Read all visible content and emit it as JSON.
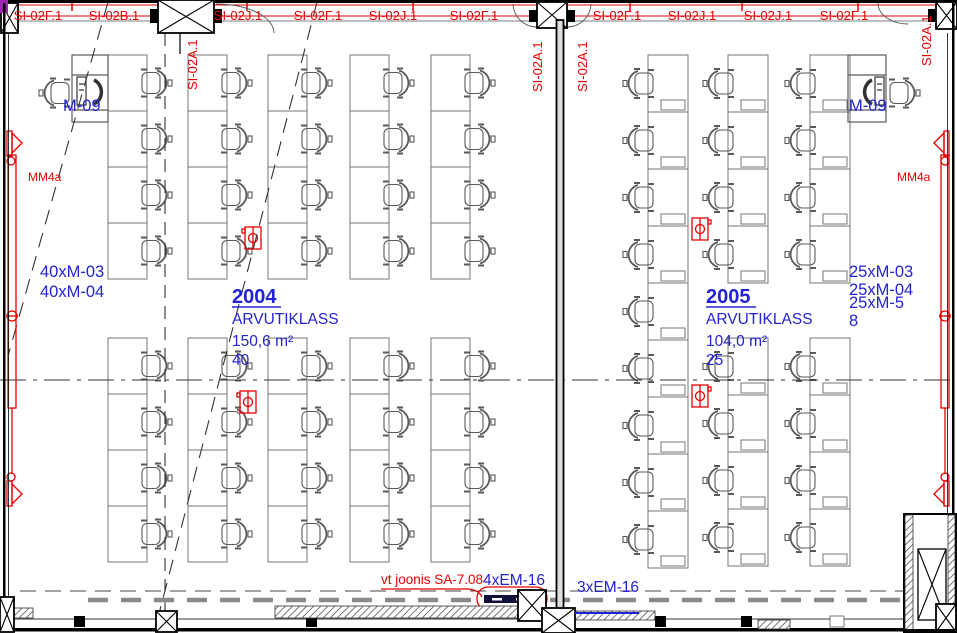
{
  "colors": {
    "annotation_red": "#e60000",
    "label_blue": "#2323d6",
    "wall_black": "#000000",
    "furniture_gray": "#767676",
    "corner_magenta": "#9c27b0"
  },
  "ann": {
    "top_labels": [
      "SI-02F.1",
      "SI-02B.1",
      "SI-02J.1",
      "SI-02F.1",
      "SI-02J.1",
      "SI-02F.1",
      "SI-02F.1",
      "SI-02J.1",
      "SI-02J.1",
      "SI-02F.1"
    ],
    "vertical_labels": [
      "SI-02A.1",
      "SI-02A.1",
      "SI-02A.1",
      "SI-02A.1"
    ],
    "mm4a": "MM4a",
    "m09": "M-09"
  },
  "room2004": {
    "number": "2004",
    "name": "ARVUTIKLASS",
    "area": "150,6 m²",
    "seats": "40",
    "eq1": "40xM-03",
    "eq2": "40xM-04"
  },
  "room2005": {
    "number": "2005",
    "name": "ARVUTIKLASS",
    "area": "104,0 m²",
    "seats": "25",
    "eq1": "25xM-03",
    "eq2": "25xM-04",
    "eq3": "25xM-5",
    "eq4": "8"
  },
  "bottom": {
    "note": "vt joonis SA-7.08",
    "em4": "4xEM-16",
    "em3": "3xEM-16"
  },
  "furniture_layout": {
    "room_2004": {
      "desk_columns": [
        108,
        188,
        268,
        350,
        431
      ],
      "desk_w": 39,
      "row_h": 56,
      "sections": [
        {
          "y0": 55,
          "rows": 4
        },
        {
          "y0": 338,
          "rows": 4
        }
      ],
      "chair_side": "right",
      "pc": false
    },
    "room_2005": {
      "desk_w": 40,
      "row_h": 57,
      "chair_side": "left",
      "pc": true,
      "columns": [
        {
          "x": 648,
          "sections": [
            {
              "y0": 55,
              "rows": 9
            }
          ]
        },
        {
          "x": 728,
          "sections": [
            {
              "y0": 55,
              "rows": 4
            },
            {
              "y0": 338,
              "rows": 4
            }
          ]
        },
        {
          "x": 810,
          "sections": [
            {
              "y0": 55,
              "rows": 4
            },
            {
              "y0": 338,
              "rows": 4
            }
          ]
        }
      ]
    }
  }
}
